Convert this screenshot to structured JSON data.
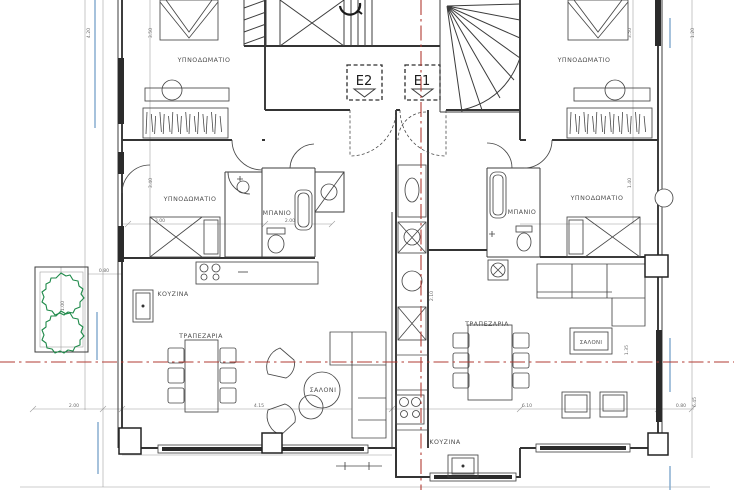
{
  "colors": {
    "wall": "#343434",
    "thin_line": "#9a9a9a",
    "section_red": "#b23b33",
    "glass_blue": "#88aed0",
    "plant_green": "#1f8a4a",
    "window_dark": "#2b2b2b",
    "background": "#ffffff"
  },
  "elevators": {
    "e1": "E1",
    "e2": "E2"
  },
  "rooms": {
    "left": {
      "bedroom_top": "ΥΠΝΟΔΩΜΑΤΙΟ",
      "bedroom_mid": "ΥΠΝΟΔΩΜΑΤΙΟ",
      "bathroom": "ΜΠΑΝΙΟ",
      "kitchen": "ΚΟΥΖΙΝΑ",
      "dining": "ΤΡΑΠΕΖΑΡΙΑ",
      "living": "ΣΑΛΟΝΙ"
    },
    "right": {
      "bedroom_top": "ΥΠΝΟΔΩΜΑΤΙΟ",
      "bedroom_mid": "ΥΠΝΟΔΩΜΑΤΙΟ",
      "bathroom": "ΜΠΑΝΙΟ",
      "kitchen": "ΚΟΥΖΙΝΑ",
      "dining": "ΤΡΑΠΕΖΑΡΙΑ",
      "living": "ΣΑΛΟΝΙ"
    }
  },
  "dimensions": [
    {
      "text": "2.00",
      "x": 74,
      "y": 407,
      "rot": 0
    },
    {
      "text": "4.15",
      "x": 259,
      "y": 407,
      "rot": 0
    },
    {
      "text": "6.10",
      "x": 527,
      "y": 407,
      "rot": 0
    },
    {
      "text": "0.80",
      "x": 681,
      "y": 407,
      "rot": 0
    },
    {
      "text": "0.80",
      "x": 104,
      "y": 272,
      "rot": 0
    },
    {
      "text": "3.00",
      "x": 160,
      "y": 222,
      "rot": 0
    },
    {
      "text": "2.00",
      "x": 290,
      "y": 222,
      "rot": 0
    },
    {
      "text": "1.00",
      "x": 64,
      "y": 306,
      "rot": -90
    },
    {
      "text": "4.20",
      "x": 90,
      "y": 33,
      "rot": -90
    },
    {
      "text": "3.50",
      "x": 152,
      "y": 33,
      "rot": -90
    },
    {
      "text": "3.40",
      "x": 152,
      "y": 183,
      "rot": -90
    },
    {
      "text": "3.50",
      "x": 631,
      "y": 33,
      "rot": -90
    },
    {
      "text": "1.40",
      "x": 631,
      "y": 183,
      "rot": -90
    },
    {
      "text": "1.20",
      "x": 694,
      "y": 33,
      "rot": -90
    },
    {
      "text": "2.10",
      "x": 433,
      "y": 296,
      "rot": -90
    },
    {
      "text": "1.35",
      "x": 628,
      "y": 350,
      "rot": -90
    },
    {
      "text": "6.45",
      "x": 696,
      "y": 402,
      "rot": -90
    }
  ]
}
